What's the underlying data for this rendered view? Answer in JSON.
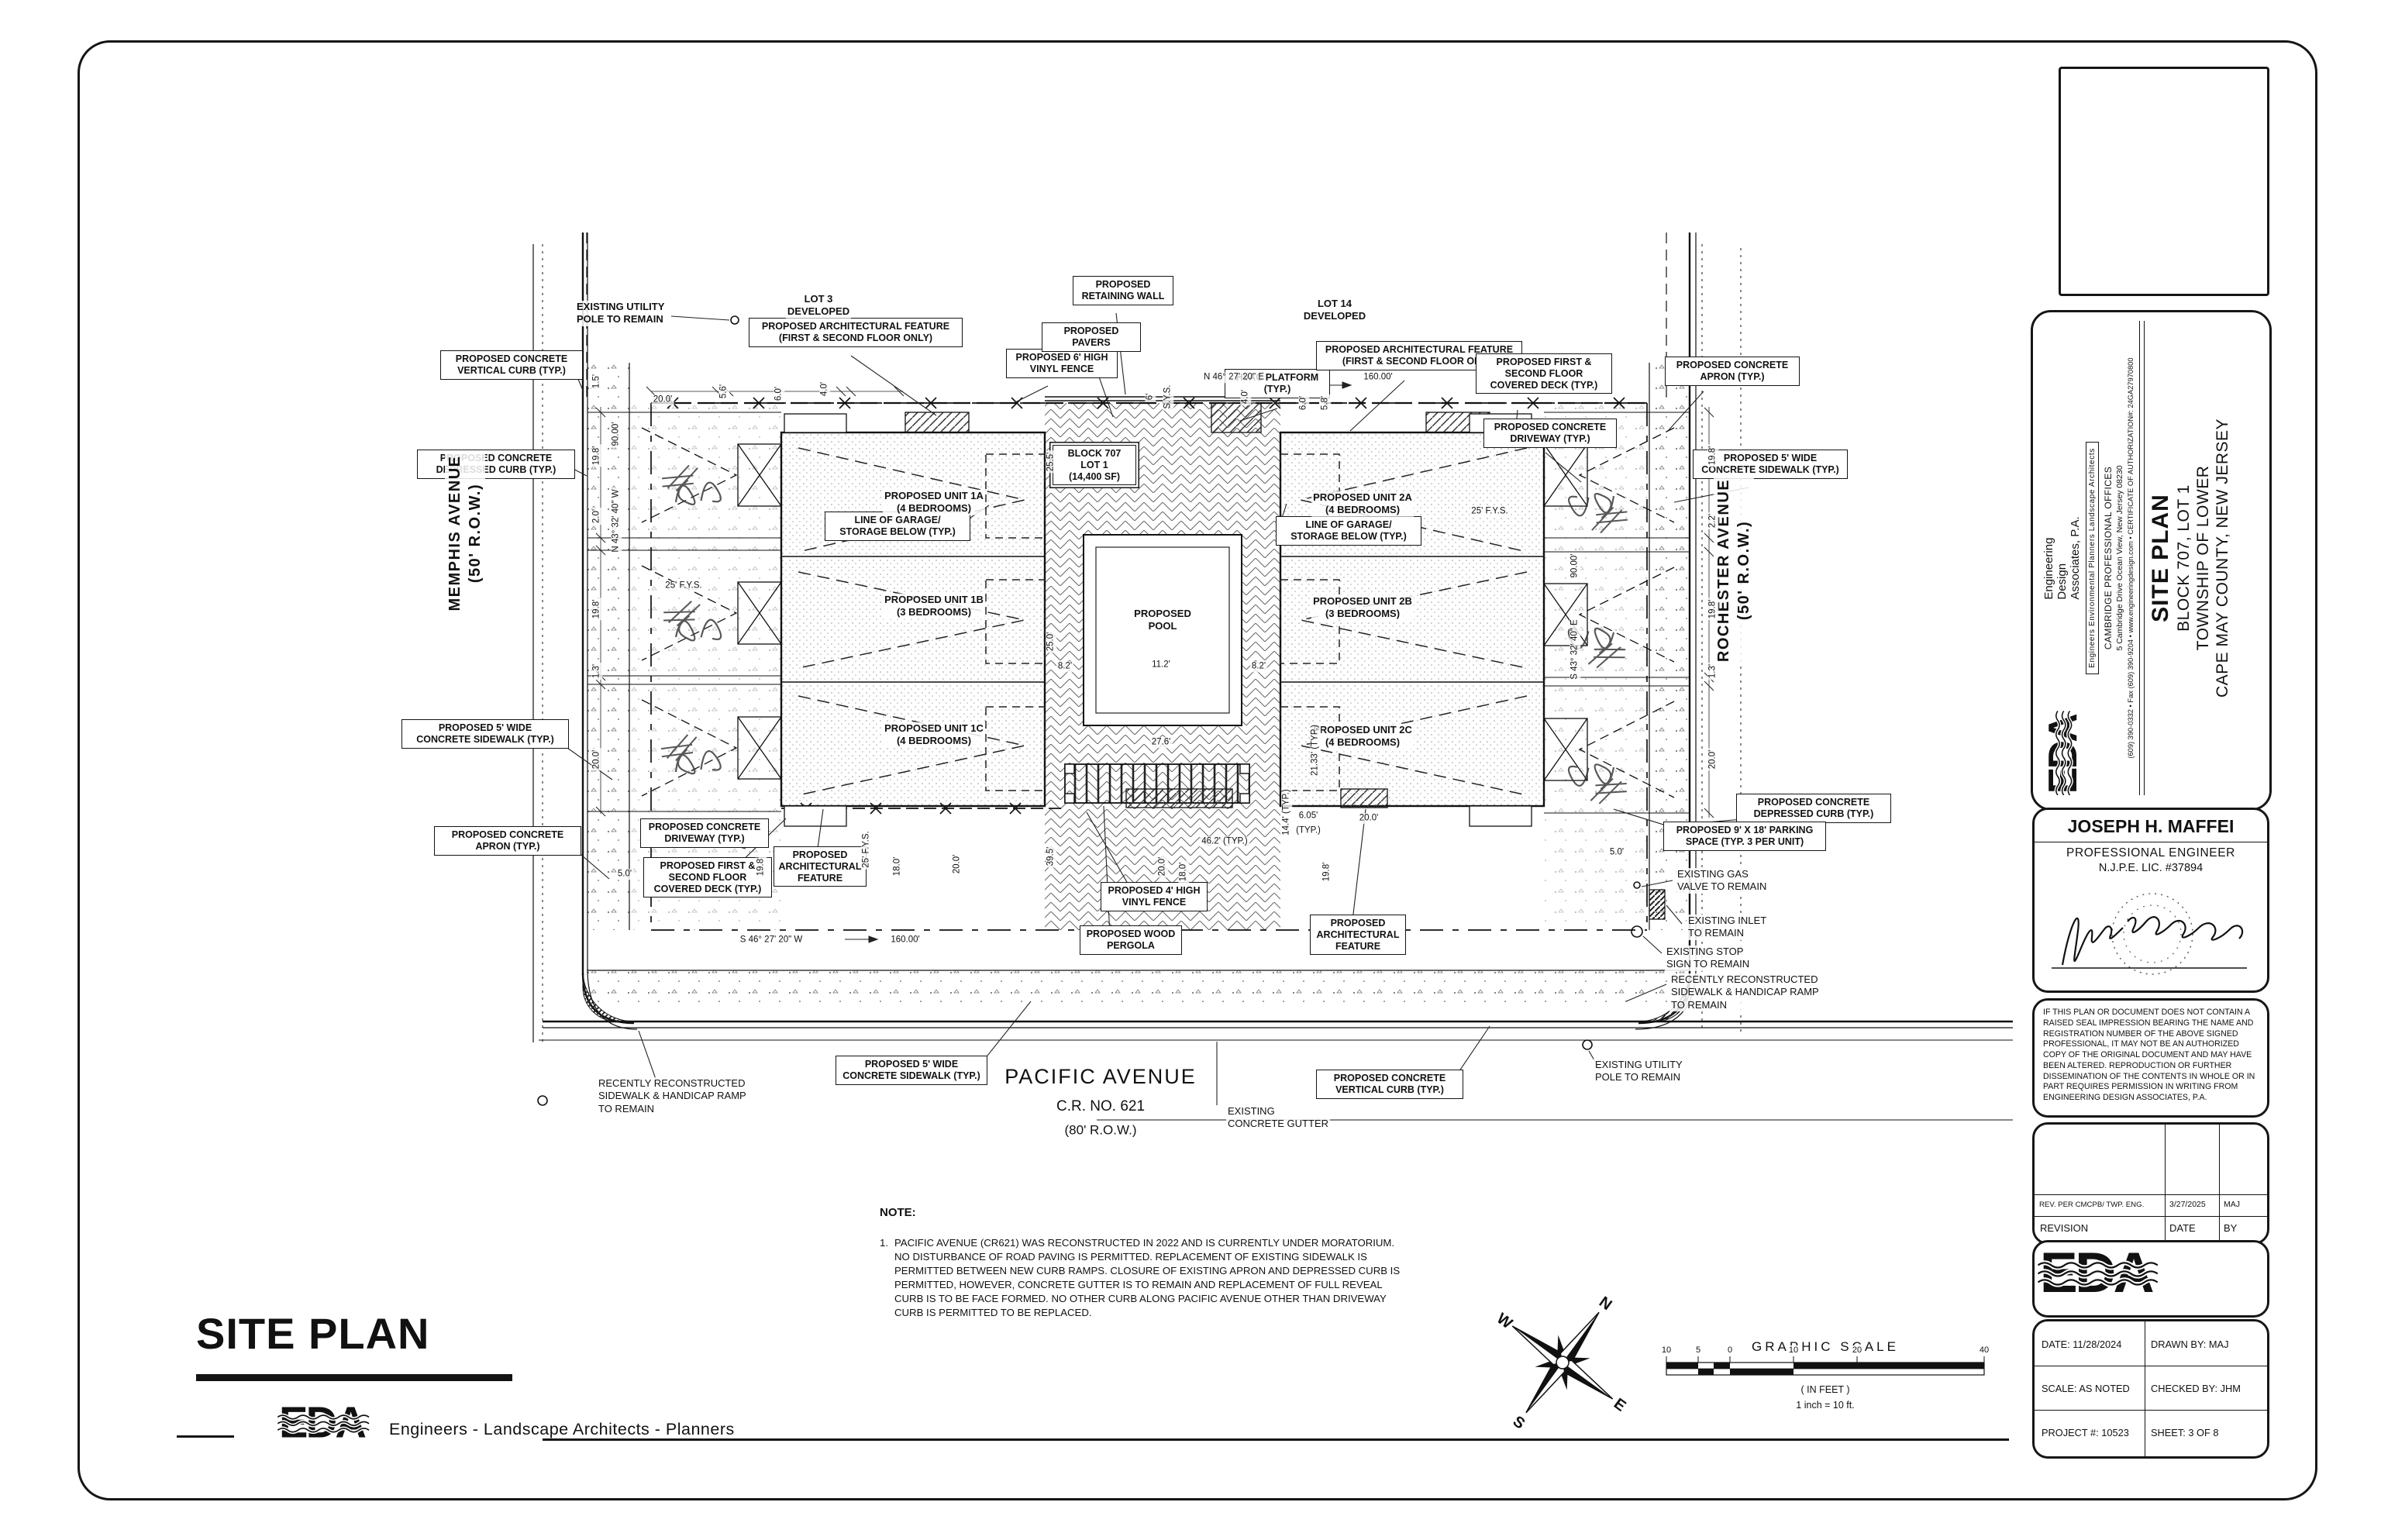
{
  "sidebar": {
    "logo": "EDA",
    "firm": "Engineering\nDesign\nAssociates, P.A.",
    "tagline": "Engineers   Environmental Planners   Landscape Architects",
    "office": "CAMBRIDGE PROFESSIONAL OFFICES",
    "address": "5 Cambridge Drive Ocean View, New Jersey 08230",
    "contact": "(609) 390-0332   •   Fax (609) 390-9204   •   www.engineeringdesign.com   •   CERTIFICATE OF AUTHORIZATION#: 24GA27970800",
    "sheet_title": "SITE PLAN",
    "line2": "BLOCK 707, LOT 1",
    "line3": "TOWNSHIP OF LOWER",
    "line4": "CAPE MAY COUNTY, NEW JERSEY"
  },
  "engineer": {
    "name": "JOSEPH H. MAFFEI",
    "title": "PROFESSIONAL ENGINEER",
    "license": "N.J.P.E. LIC. #37894"
  },
  "disclaimer": "IF THIS PLAN OR DOCUMENT DOES NOT CONTAIN A RAISED SEAL IMPRESSION BEARING THE NAME AND REGISTRATION NUMBER OF THE ABOVE SIGNED PROFESSIONAL, IT MAY NOT BE AN AUTHORIZED COPY OF THE ORIGINAL DOCUMENT AND MAY HAVE BEEN ALTERED.  REPRODUCTION OR FURTHER DISSEMINATION OF THE CONTENTS IN WHOLE OR IN PART REQUIRES PERMISSION IN WRITING FROM ENGINEERING DESIGN ASSOCIATES, P.A.",
  "revisions": {
    "entry": {
      "desc": "REV. PER CMCPB/ TWP. ENG.",
      "date": "3/27/2025",
      "by": "MAJ"
    },
    "headers": {
      "revision": "REVISION",
      "date": "DATE",
      "by": "BY"
    }
  },
  "info": {
    "date": "DATE: 11/28/2024",
    "drawn": "DRAWN BY: MAJ",
    "scale": "SCALE: AS NOTED",
    "checked": "CHECKED BY: JHM",
    "project": "PROJECT #: 10523",
    "sheet": "SHEET: 3  OF 8"
  },
  "footer": {
    "title": "SITE PLAN",
    "logo": "EDA",
    "tagline": "Engineers - Landscape Architects - Planners"
  },
  "note": {
    "heading": "NOTE:",
    "number": "1.",
    "text": "PACIFIC AVENUE (CR621) WAS RECONSTRUCTED IN 2022 AND IS CURRENTLY UNDER MORATORIUM. NO DISTURBANCE OF ROAD PAVING IS PERMITTED. REPLACEMENT OF EXISTING SIDEWALK IS PERMITTED BETWEEN NEW CURB RAMPS. CLOSURE OF EXISTING APRON AND DEPRESSED CURB IS PERMITTED, HOWEVER, CONCRETE GUTTER IS TO REMAIN AND REPLACEMENT OF FULL REVEAL CURB IS TO BE FACE FORMED. NO OTHER CURB ALONG PACIFIC AVENUE OTHER THAN DRIVEWAY CURB IS PERMITTED TO BE REPLACED."
  },
  "scalebar": {
    "title": "GRAPHIC SCALE",
    "ticks": [
      "10",
      "5",
      "0",
      "10",
      "20",
      "40"
    ],
    "in_feet": "( IN FEET )",
    "ratio": "1 inch = 10  ft."
  },
  "compass": {
    "n": "N",
    "e": "E",
    "s": "S",
    "w": "W"
  },
  "callouts": [
    {
      "t": "PROPOSED CONCRETE\nVERTICAL CURB (TYP.)"
    },
    {
      "t": "PROPOSED CONCRETE\nDEPRESSED CURB (TYP.)"
    },
    {
      "t": "PROPOSED 5' WIDE\nCONCRETE SIDEWALK (TYP.)"
    },
    {
      "t": "PROPOSED CONCRETE\nAPRON (TYP.)"
    },
    {
      "t": "PROPOSED ARCHITECTURAL FEATURE\n(FIRST & SECOND FLOOR ONLY)"
    },
    {
      "t": "PROPOSED 6' HIGH\nVINYL FENCE"
    },
    {
      "t": "PROPOSED\nRETAINING WALL"
    },
    {
      "t": "PROPOSED PAVERS"
    },
    {
      "t": "HVAC PLATFORM\n(TYP.)"
    },
    {
      "t": "PROPOSED ARCHITECTURAL FEATURE\n(FIRST & SECOND FLOOR ONLY)"
    },
    {
      "t": "PROPOSED FIRST &\nSECOND FLOOR\nCOVERED DECK (TYP.)"
    },
    {
      "t": "PROPOSED CONCRETE\nDRIVEWAY (TYP.)"
    },
    {
      "t": "PROPOSED CONCRETE\nAPRON (TYP.)"
    },
    {
      "t": "PROPOSED 5' WIDE\nCONCRETE SIDEWALK (TYP.)"
    },
    {
      "t": "PROPOSED CONCRETE\nDEPRESSED CURB (TYP.)"
    },
    {
      "t": "PROPOSED 9' X 18' PARKING\nSPACE (TYP. 3 PER UNIT)"
    },
    {
      "t": "BLOCK 707\nLOT 1\n(14,400 SF)"
    },
    {
      "t": "LINE OF GARAGE/\nSTORAGE BELOW (TYP.)"
    },
    {
      "t": "LINE OF GARAGE/\nSTORAGE BELOW (TYP.)"
    },
    {
      "t": "PROPOSED CONCRETE\nDRIVEWAY (TYP.)"
    },
    {
      "t": "PROPOSED FIRST &\nSECOND FLOOR\nCOVERED DECK (TYP.)"
    },
    {
      "t": "PROPOSED\nARCHITECTURAL\nFEATURE"
    },
    {
      "t": "PROPOSED 4' HIGH\nVINYL FENCE"
    },
    {
      "t": "PROPOSED WOOD\nPERGOLA"
    },
    {
      "t": "PROPOSED\nARCHITECTURAL\nFEATURE"
    },
    {
      "t": "PROPOSED 5' WIDE\nCONCRETE SIDEWALK (TYP.)"
    },
    {
      "t": "PROPOSED CONCRETE\nVERTICAL CURB (TYP.)"
    }
  ],
  "plain": [
    {
      "t": "EXISTING UTILITY\nPOLE TO REMAIN"
    },
    {
      "t": "LOT 3\nDEVELOPED"
    },
    {
      "t": "LOT 14\nDEVELOPED"
    },
    {
      "t": "PROPOSED UNIT 1A\n(4 BEDROOMS)"
    },
    {
      "t": "PROPOSED UNIT 1B\n(3 BEDROOMS)"
    },
    {
      "t": "PROPOSED UNIT 1C\n(4 BEDROOMS)"
    },
    {
      "t": "PROPOSED UNIT 2A\n(4 BEDROOMS)"
    },
    {
      "t": "PROPOSED UNIT 2B\n(3 BEDROOMS)"
    },
    {
      "t": "PROPOSED UNIT 2C\n(4 BEDROOMS)"
    },
    {
      "t": "PROPOSED\nPOOL"
    },
    {
      "t": "MEMPHIS AVENUE\n(50' R.O.W.)"
    },
    {
      "t": "ROCHESTER AVENUE\n(50' R.O.W.)"
    },
    {
      "t": "PACIFIC AVENUE"
    },
    {
      "t": "C.R. NO. 621"
    },
    {
      "t": "(80' R.O.W.)"
    },
    {
      "t": "EXISTING\nCONCRETE GUTTER"
    },
    {
      "t": "EXISTING GAS\nVALVE TO REMAIN"
    },
    {
      "t": "EXISTING INLET\nTO REMAIN"
    },
    {
      "t": "EXISTING STOP\nSIGN TO REMAIN"
    },
    {
      "t": "RECENTLY RECONSTRUCTED\nSIDEWALK & HANDICAP RAMP\nTO REMAIN"
    },
    {
      "t": "EXISTING UTILITY\nPOLE TO REMAIN"
    },
    {
      "t": "RECENTLY RECONSTRUCTED\nSIDEWALK & HANDICAP RAMP\nTO REMAIN"
    }
  ],
  "dims": [
    {
      "t": "20.0'"
    },
    {
      "t": "5.6'"
    },
    {
      "t": "6.0'"
    },
    {
      "t": "4.0'"
    },
    {
      "t": "6'"
    },
    {
      "t": "S.Y.S."
    },
    {
      "t": "4.0'"
    },
    {
      "t": "6.0'"
    },
    {
      "t": "5.8'"
    },
    {
      "t": "N 46° 27' 20\" E"
    },
    {
      "t": "160.00'"
    },
    {
      "t": "S 46° 27' 20\" W"
    },
    {
      "t": "160.00'"
    },
    {
      "t": "90.00'"
    },
    {
      "t": "N 43° 32' 40\" W"
    },
    {
      "t": "S 43° 32' 40\" E"
    },
    {
      "t": "90.00'"
    },
    {
      "t": "1.5'"
    },
    {
      "t": "19.8'"
    },
    {
      "t": "2.0'"
    },
    {
      "t": "19.8'"
    },
    {
      "t": "1.3'"
    },
    {
      "t": "20.0'"
    },
    {
      "t": "5.0'"
    },
    {
      "t": "19.8'"
    },
    {
      "t": "2.2'"
    },
    {
      "t": "19.8'"
    },
    {
      "t": "1.3'"
    },
    {
      "t": "20.0'"
    },
    {
      "t": "5.0'"
    },
    {
      "t": "19.8'"
    },
    {
      "t": "25' F.Y.S."
    },
    {
      "t": "18.0'"
    },
    {
      "t": "20.0'"
    },
    {
      "t": "20.0'"
    },
    {
      "t": "18.0'"
    },
    {
      "t": "46.2' (TYP.)"
    },
    {
      "t": "6.05'"
    },
    {
      "t": "(TYP.)"
    },
    {
      "t": "20.0'"
    },
    {
      "t": "19.8'"
    },
    {
      "t": "14.4' (TYP.)"
    },
    {
      "t": "21.33' (TYP.)"
    },
    {
      "t": "25.5'"
    },
    {
      "t": "25.0'"
    },
    {
      "t": "8.2'"
    },
    {
      "t": "11.2'"
    },
    {
      "t": "8.2'"
    },
    {
      "t": "27.6'"
    },
    {
      "t": "39.5'"
    },
    {
      "t": "25' F.Y.S."
    },
    {
      "t": "25' F.Y.S."
    }
  ]
}
